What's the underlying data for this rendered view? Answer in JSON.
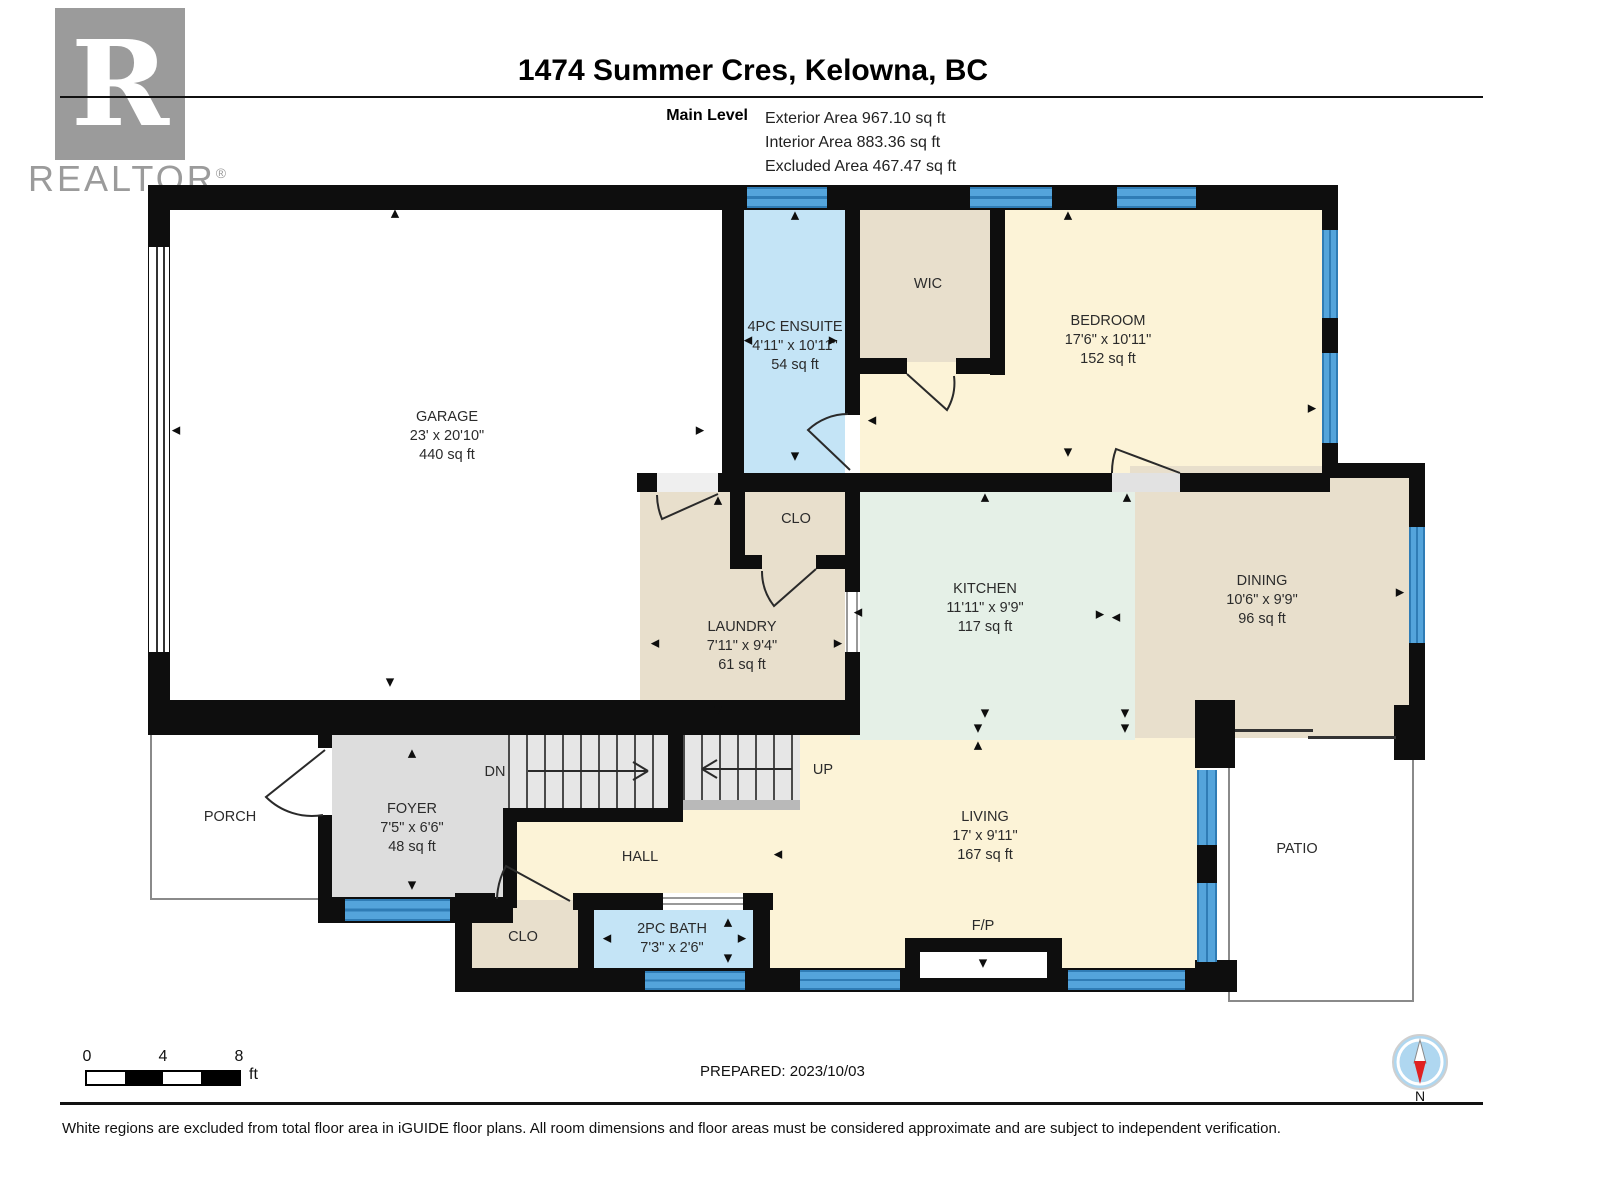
{
  "header": {
    "logo_text": "REALTOR",
    "logo_reg": "®",
    "logo_letter": "R",
    "title": "1474 Summer Cres, Kelowna, BC",
    "level_label": "Main Level",
    "areas": [
      "Exterior Area 967.10 sq ft",
      "Interior Area 883.36 sq ft",
      "Excluded Area 467.47 sq ft"
    ]
  },
  "plan": {
    "rooms": [
      {
        "id": "garage",
        "lines": [
          "GARAGE",
          "23' x 20'10\"",
          "440 sq ft"
        ],
        "x": 447,
        "y": 408
      },
      {
        "id": "ensuite",
        "lines": [
          "4PC ENSUITE",
          "4'11\" x 10'11\"",
          "54 sq ft"
        ],
        "x": 795,
        "y": 318
      },
      {
        "id": "wic",
        "lines": [
          "WIC"
        ],
        "x": 928,
        "y": 275
      },
      {
        "id": "bedroom",
        "lines": [
          "BEDROOM",
          "17'6\" x 10'11\"",
          "152 sq ft"
        ],
        "x": 1108,
        "y": 312
      },
      {
        "id": "closet-upper",
        "lines": [
          "CLO"
        ],
        "x": 796,
        "y": 510
      },
      {
        "id": "laundry",
        "lines": [
          "LAUNDRY",
          "7'11\" x 9'4\"",
          "61 sq ft"
        ],
        "x": 742,
        "y": 618
      },
      {
        "id": "kitchen",
        "lines": [
          "KITCHEN",
          "11'11\" x 9'9\"",
          "117 sq ft"
        ],
        "x": 985,
        "y": 580
      },
      {
        "id": "dining",
        "lines": [
          "DINING",
          "10'6\" x 9'9\"",
          "96 sq ft"
        ],
        "x": 1262,
        "y": 572
      },
      {
        "id": "porch",
        "lines": [
          "PORCH"
        ],
        "x": 230,
        "y": 808
      },
      {
        "id": "foyer",
        "lines": [
          "FOYER",
          "7'5\" x 6'6\"",
          "48 sq ft"
        ],
        "x": 412,
        "y": 800
      },
      {
        "id": "hall",
        "lines": [
          "HALL"
        ],
        "x": 640,
        "y": 848
      },
      {
        "id": "living",
        "lines": [
          "LIVING",
          "17' x 9'11\"",
          "167 sq ft"
        ],
        "x": 985,
        "y": 808
      },
      {
        "id": "patio",
        "lines": [
          "PATIO"
        ],
        "x": 1297,
        "y": 840
      },
      {
        "id": "closet-lower",
        "lines": [
          "CLO"
        ],
        "x": 523,
        "y": 928
      },
      {
        "id": "bath",
        "lines": [
          "2PC BATH",
          "7'3\" x 2'6\""
        ],
        "x": 672,
        "y": 920
      },
      {
        "id": "fireplace",
        "lines": [
          "F/P"
        ],
        "x": 983,
        "y": 917
      },
      {
        "id": "stairs-down",
        "lines": [
          "DN"
        ],
        "x": 495,
        "y": 763
      },
      {
        "id": "stairs-up",
        "lines": [
          "UP"
        ],
        "x": 823,
        "y": 761
      }
    ],
    "arrows": [
      {
        "dir": "u",
        "x": 395,
        "y": 213
      },
      {
        "dir": "u",
        "x": 795,
        "y": 215
      },
      {
        "dir": "u",
        "x": 1068,
        "y": 215
      },
      {
        "dir": "u",
        "x": 718,
        "y": 500
      },
      {
        "dir": "u",
        "x": 985,
        "y": 497
      },
      {
        "dir": "u",
        "x": 1127,
        "y": 497
      },
      {
        "dir": "u",
        "x": 412,
        "y": 753
      },
      {
        "dir": "u",
        "x": 978,
        "y": 745
      },
      {
        "dir": "u",
        "x": 728,
        "y": 922
      },
      {
        "dir": "d",
        "x": 390,
        "y": 682
      },
      {
        "dir": "d",
        "x": 795,
        "y": 456
      },
      {
        "dir": "d",
        "x": 1068,
        "y": 452
      },
      {
        "dir": "d",
        "x": 718,
        "y": 710
      },
      {
        "dir": "d",
        "x": 985,
        "y": 713
      },
      {
        "dir": "d",
        "x": 1125,
        "y": 713
      },
      {
        "dir": "d",
        "x": 412,
        "y": 885
      },
      {
        "dir": "d",
        "x": 978,
        "y": 728
      },
      {
        "dir": "d",
        "x": 1125,
        "y": 728
      },
      {
        "dir": "d",
        "x": 983,
        "y": 963
      },
      {
        "dir": "d",
        "x": 728,
        "y": 958
      },
      {
        "dir": "l",
        "x": 176,
        "y": 430
      },
      {
        "dir": "l",
        "x": 748,
        "y": 340
      },
      {
        "dir": "l",
        "x": 872,
        "y": 420
      },
      {
        "dir": "l",
        "x": 655,
        "y": 643
      },
      {
        "dir": "l",
        "x": 858,
        "y": 612
      },
      {
        "dir": "l",
        "x": 1116,
        "y": 617
      },
      {
        "dir": "l",
        "x": 607,
        "y": 938
      },
      {
        "dir": "l",
        "x": 778,
        "y": 854
      },
      {
        "dir": "r",
        "x": 700,
        "y": 430
      },
      {
        "dir": "r",
        "x": 833,
        "y": 340
      },
      {
        "dir": "r",
        "x": 1312,
        "y": 408
      },
      {
        "dir": "r",
        "x": 838,
        "y": 643
      },
      {
        "dir": "r",
        "x": 1100,
        "y": 614
      },
      {
        "dir": "r",
        "x": 1400,
        "y": 592
      },
      {
        "dir": "r",
        "x": 1205,
        "y": 860
      },
      {
        "dir": "r",
        "x": 742,
        "y": 938
      }
    ]
  },
  "footer": {
    "prepared": "PREPARED: 2023/10/03",
    "disclaimer": "White regions are excluded from total floor area in iGUIDE floor plans. All room dimensions and floor areas must be considered approximate and are subject to independent verification.",
    "scale_ticks": [
      "0",
      "4",
      "8"
    ],
    "scale_unit": "ft",
    "compass_label": "N"
  },
  "colors": {
    "wall": "#0e0e0e",
    "window_blue": "#54A4DB",
    "room_yellow": "#FCF3D7",
    "room_tan": "#E8DFCC",
    "room_mint": "#E5F0E7",
    "room_blue": "#C4E4F6",
    "room_grey": "#DDDDDD",
    "logo_grey": "#9b9b9b"
  }
}
